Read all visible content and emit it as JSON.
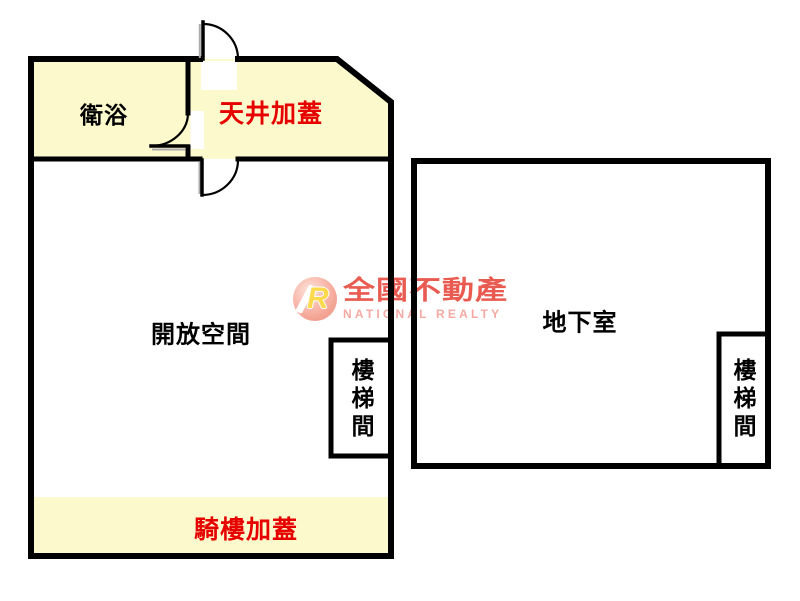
{
  "floorplan": {
    "left_building": {
      "rooms": {
        "bathroom": {
          "label": "衛浴"
        },
        "skylight_addition": {
          "label": "天井加蓋"
        },
        "open_space": {
          "label": "開放空間"
        },
        "stairwell": {
          "label": "樓梯間"
        },
        "arcade_addition": {
          "label": "騎樓加蓋"
        }
      },
      "doors": [
        "door-top",
        "door-bathroom",
        "door-bottom"
      ]
    },
    "right_building": {
      "rooms": {
        "basement": {
          "label": "地下室"
        },
        "stairwell": {
          "label": "樓梯間"
        }
      }
    }
  },
  "watermark": {
    "logo_letter": "R",
    "company_name": "全國不動產",
    "company_name_en": "NATIONAL REALTY"
  },
  "colors": {
    "wall": "#000000",
    "annex_yellow": "#FCF9CC",
    "label_black": "#000000",
    "label_red": "#E60000",
    "door_shadow": "#ABABAB",
    "wm_red": "#E95A50",
    "wm_pink": "#F5A9A2",
    "wm_gold": "#FFD94D"
  }
}
